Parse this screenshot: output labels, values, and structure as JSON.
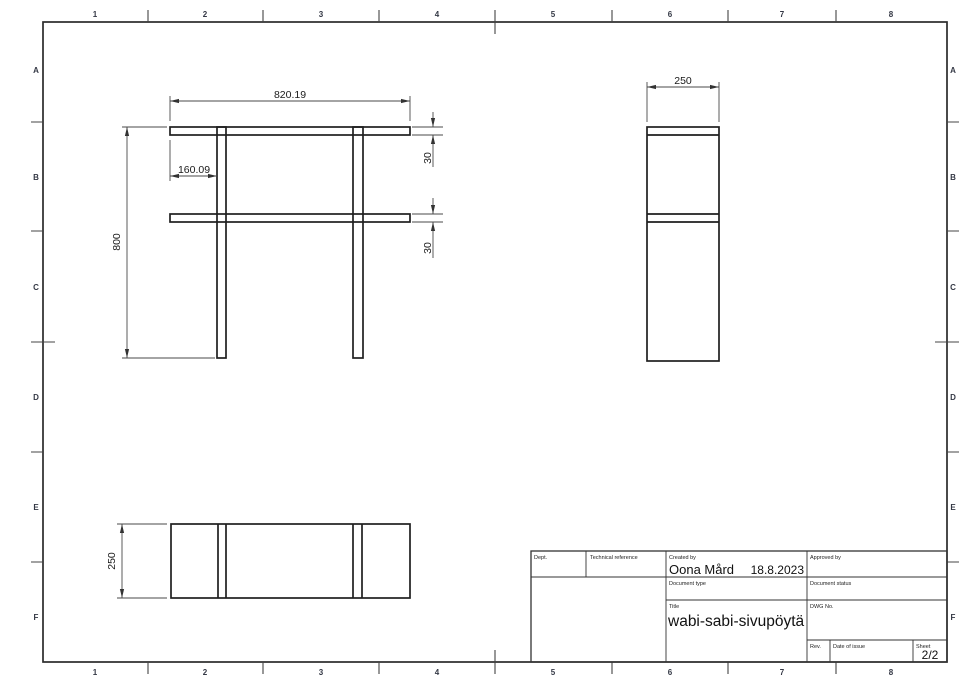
{
  "drawing": {
    "grid": {
      "cols": [
        "1",
        "2",
        "3",
        "4",
        "5",
        "6",
        "7",
        "8"
      ],
      "rows": [
        "A",
        "B",
        "C",
        "D",
        "E",
        "F"
      ]
    },
    "dims": {
      "front_width": "820.19",
      "leg_offset": "160.09",
      "front_height": "800",
      "top_thickness": "30",
      "shelf_thickness": "30",
      "side_depth": "250",
      "plan_depth": "250"
    },
    "title_block": {
      "dept_label": "Dept.",
      "technical_reference_label": "Technical reference",
      "created_by_label": "Created by",
      "created_by": "Oona Mård",
      "created_date": "18.8.2023",
      "approved_by_label": "Approved by",
      "document_type_label": "Document type",
      "document_status_label": "Document status",
      "title_label": "Title",
      "title": "wabi-sabi-sivupöytä",
      "dwg_no_label": "DWG No.",
      "rev_label": "Rev.",
      "date_of_issue_label": "Date of issue",
      "sheet_label": "Sheet",
      "sheet": "2/2"
    },
    "colors": {
      "outline": "#1f1f1f",
      "dimension": "#4a4a4a",
      "frame": "#2b2b2b",
      "background": "#ffffff"
    }
  }
}
